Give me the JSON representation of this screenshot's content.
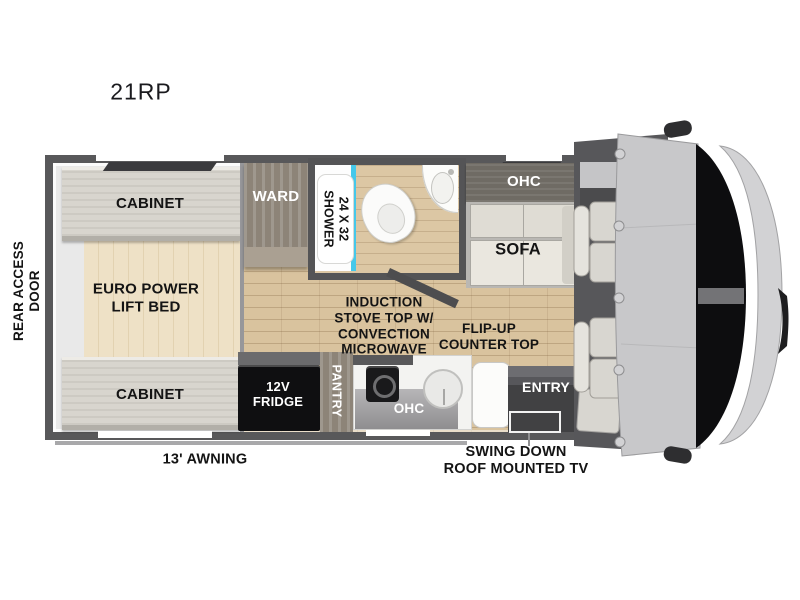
{
  "title": "21RP",
  "exterior": {
    "rear_door": "REAR ACCESS\nDOOR",
    "awning": "13' AWNING",
    "tv_note": "SWING DOWN\nROOF MOUNTED TV"
  },
  "bedroom": {
    "cabinet_top": "CABINET",
    "bed": "EURO POWER\nLIFT BED",
    "cabinet_bottom": "CABINET",
    "ward": "WARD"
  },
  "bath": {
    "shower": "24 X 32\nSHOWER"
  },
  "living": {
    "ohc": "OHC",
    "sofa": "SOFA"
  },
  "kitchen": {
    "note": "INDUCTION\nSTOVE TOP W/\nCONVECTION\nMICROWAVE",
    "counter_note": "FLIP-UP\nCOUNTER TOP",
    "fridge": "12V\nFRIDGE",
    "pantry": "PANTRY",
    "ohc": "OHC",
    "entry": "ENTRY"
  },
  "colors": {
    "wall": "#58585a",
    "floor_wood": "#d9c39e",
    "bed_wood": "#eadcc0",
    "cabinet_light": "#d8d5ce",
    "cabinet_dark": "#6f6b64",
    "fridge_black": "#0f0f11",
    "shower_glass": "#45c8ea",
    "text_dark": "#141414",
    "text_light": "#ffffff"
  }
}
